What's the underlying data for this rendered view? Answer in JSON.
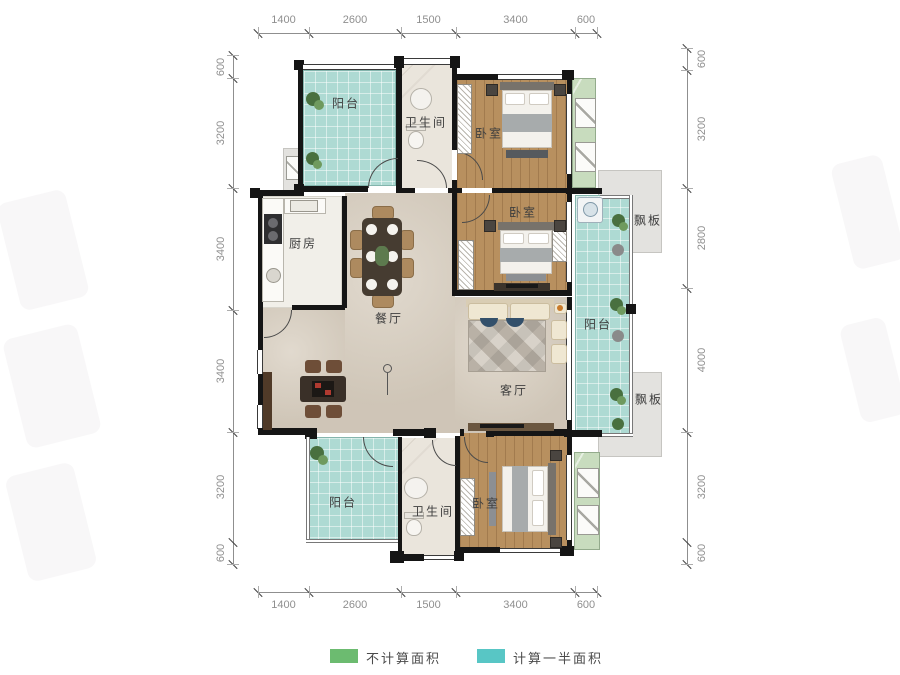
{
  "rooms": {
    "balcony_top_left": "阳台",
    "bathroom_top": "卫生间",
    "bedroom_top": "卧室",
    "board_top": "飘板",
    "kitchen": "厨房",
    "dining": "餐厅",
    "bedroom_middle": "卧室",
    "balcony_right": "阳台",
    "living": "客厅",
    "board_bottom": "飘板",
    "balcony_bottom_left": "阳台",
    "bathroom_bottom": "卫生间",
    "bedroom_bottom": "卧室"
  },
  "dimensions": {
    "top": [
      "1400",
      "2600",
      "1500",
      "3400",
      "600"
    ],
    "bottom": [
      "1400",
      "2600",
      "1500",
      "3400",
      "600"
    ],
    "left": [
      "600",
      "3200",
      "3400",
      "3400",
      "3200",
      "600"
    ],
    "right": [
      "600",
      "3200",
      "2800",
      "4000",
      "3200",
      "600"
    ]
  },
  "legend": {
    "items": [
      {
        "color": "#6cbb70",
        "label": "不计算面积"
      },
      {
        "color": "#58c6c5",
        "label": "计算一半面积"
      }
    ]
  },
  "colors": {
    "wall": "#151515",
    "balcony_floor": "#aedad3",
    "wood_floor": "#b8905f",
    "living_floor": "#d7cdbe",
    "marble_floor": "#eae5dc",
    "bay_green": "#c8dcbe",
    "board_gray": "#e3e2df"
  }
}
